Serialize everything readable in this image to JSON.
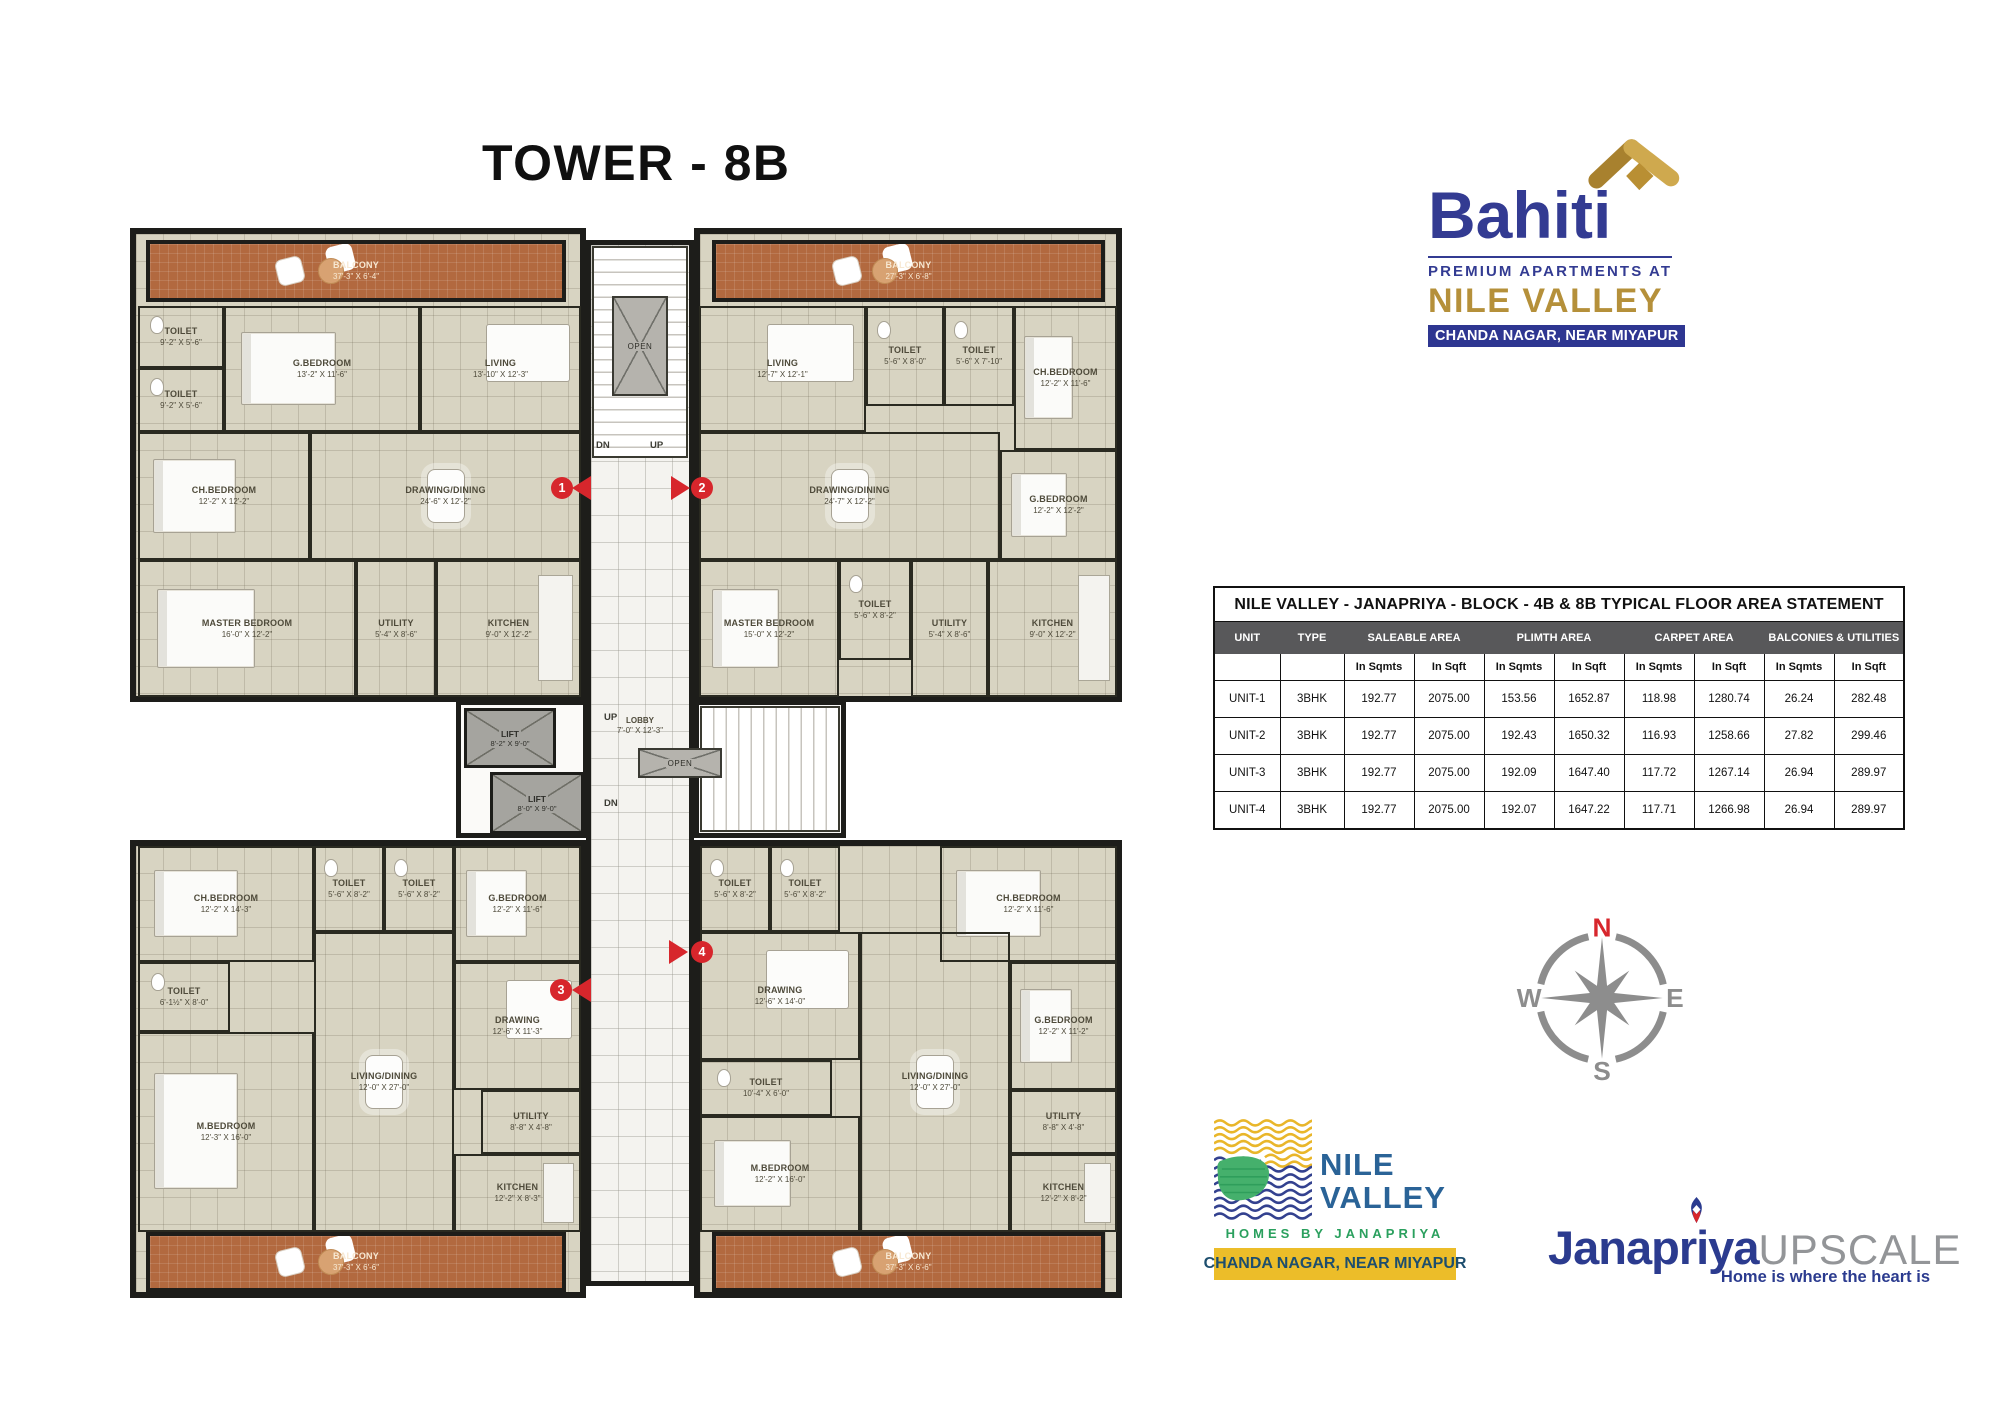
{
  "page": {
    "title": "TOWER - 8B"
  },
  "bahiti": {
    "name": "Bahiti",
    "subtitle": "PREMIUM APARTMENTS AT",
    "project": "NILE VALLEY",
    "location": "CHANDA NAGAR, NEAR MIYAPUR",
    "navy": "#333b92",
    "gold": "#b5903a"
  },
  "table": {
    "title": "NILE VALLEY - JANAPRIYA - BLOCK - 4B & 8B TYPICAL FLOOR AREA STATEMENT",
    "col_unit": "UNIT",
    "col_type": "TYPE",
    "groups": [
      "SALEABLE AREA",
      "PLIMTH AREA",
      "CARPET AREA",
      "BALCONIES & UTILITIES"
    ],
    "sub_sqmts": "In Sqmts",
    "sub_sqft": "In Sqft",
    "rows": [
      {
        "unit": "UNIT-1",
        "type": "3BHK",
        "values": [
          "192.77",
          "2075.00",
          "153.56",
          "1652.87",
          "118.98",
          "1280.74",
          "26.24",
          "282.48"
        ]
      },
      {
        "unit": "UNIT-2",
        "type": "3BHK",
        "values": [
          "192.77",
          "2075.00",
          "192.43",
          "1650.32",
          "116.93",
          "1258.66",
          "27.82",
          "299.46"
        ]
      },
      {
        "unit": "UNIT-3",
        "type": "3BHK",
        "values": [
          "192.77",
          "2075.00",
          "192.09",
          "1647.40",
          "117.72",
          "1267.14",
          "26.94",
          "289.97"
        ]
      },
      {
        "unit": "UNIT-4",
        "type": "3BHK",
        "values": [
          "192.77",
          "2075.00",
          "192.07",
          "1647.22",
          "117.71",
          "1266.98",
          "26.94",
          "289.97"
        ]
      }
    ]
  },
  "compass": {
    "n": "N",
    "e": "E",
    "s": "S",
    "w": "W"
  },
  "nile_valley_logo": {
    "line1": "NILE",
    "line2": "VALLEY",
    "homes": "HOMES BY JANAPRIYA",
    "location": "CHANDA NAGAR, NEAR MIYAPUR"
  },
  "janapriya_logo": {
    "name": "Janapriya",
    "upscale": "UPSCALE",
    "tagline": "Home is where the heart is"
  },
  "plan": {
    "markers": [
      "1",
      "2",
      "3",
      "4"
    ],
    "core": {
      "open": "OPEN",
      "up": "UP",
      "dn": "DN",
      "lobby": "LOBBY",
      "lobby_dims": "7'-0\" X 12'-3\"",
      "lift": "LIFT",
      "lift1_dims": "8'-2\" X 9'-0\"",
      "lift2_dims": "8'-0\" X 9'-0\""
    },
    "units": [
      {
        "name": "UNIT-1",
        "rooms": [
          {
            "name": "BALCONY",
            "dims": "37'-3\" X 6'-4\""
          },
          {
            "name": "TOILET",
            "dims": "9'-2\" X 5'-6\""
          },
          {
            "name": "G.BEDROOM",
            "dims": "13'-2\" X 11'-6\""
          },
          {
            "name": "LIVING",
            "dims": "13'-10\" X 12'-3\""
          },
          {
            "name": "TOILET",
            "dims": "9'-2\" X 5'-6\""
          },
          {
            "name": "DRAWING/DINING",
            "dims": "24'-6\" X 12'-2\""
          },
          {
            "name": "CH.BEDROOM",
            "dims": "12'-2\" X 12'-2\""
          },
          {
            "name": "MASTER BEDROOM",
            "dims": "16'-0\" X 12'-2\""
          },
          {
            "name": "UTILITY",
            "dims": "5'-4\" X 8'-6\""
          },
          {
            "name": "KITCHEN",
            "dims": "9'-0\" X 12'-2\""
          }
        ]
      },
      {
        "name": "UNIT-2",
        "rooms": [
          {
            "name": "BALCONY",
            "dims": "27'-3\" X 6'-8\""
          },
          {
            "name": "LIVING",
            "dims": "12'-7\" X 12'-1\""
          },
          {
            "name": "TOILET",
            "dims": "5'-6\" X 8'-0\""
          },
          {
            "name": "TOILET",
            "dims": "5'-6\" X 7'-10\""
          },
          {
            "name": "CH.BEDROOM",
            "dims": "12'-2\" X 11'-6\""
          },
          {
            "name": "DRAWING/DINING",
            "dims": "24'-7\" X 12'-2\""
          },
          {
            "name": "G.BEDROOM",
            "dims": "12'-2\" X 12'-2\""
          },
          {
            "name": "MASTER BEDROOM",
            "dims": "15'-0\" X 12'-2\""
          },
          {
            "name": "TOILET",
            "dims": "5'-6\" X 8'-2\""
          },
          {
            "name": "UTILITY",
            "dims": "5'-4\" X 8'-6\""
          },
          {
            "name": "KITCHEN",
            "dims": "9'-0\" X 12'-2\""
          }
        ]
      },
      {
        "name": "UNIT-3",
        "rooms": [
          {
            "name": "CH.BEDROOM",
            "dims": "12'-2\" X 14'-3\""
          },
          {
            "name": "TOILET",
            "dims": "5'-6\" X 8'-2\""
          },
          {
            "name": "TOILET",
            "dims": "5'-6\" X 8'-2\""
          },
          {
            "name": "G.BEDROOM",
            "dims": "12'-2\" X 11'-6\""
          },
          {
            "name": "DRAWING",
            "dims": "12'-6\" X 11'-3\""
          },
          {
            "name": "TOILET",
            "dims": "6'-1½\" X 8'-0\""
          },
          {
            "name": "M.BEDROOM",
            "dims": "12'-3\" X 16'-0\""
          },
          {
            "name": "LIVING/DINING",
            "dims": "12'-0\" X 27'-0\""
          },
          {
            "name": "UTILITY",
            "dims": "8'-8\" X 4'-8\""
          },
          {
            "name": "KITCHEN",
            "dims": "12'-2\" X 8'-3\""
          },
          {
            "name": "BALCONY",
            "dims": "37'-3\" X 6'-6\""
          }
        ]
      },
      {
        "name": "UNIT-4",
        "rooms": [
          {
            "name": "TOILET",
            "dims": "5'-6\" X 8'-2\""
          },
          {
            "name": "TOILET",
            "dims": "5'-6\" X 8'-2\""
          },
          {
            "name": "CH.BEDROOM",
            "dims": "12'-2\" X 11'-6\""
          },
          {
            "name": "DRAWING",
            "dims": "12'-6\" X 14'-0\""
          },
          {
            "name": "TOILET",
            "dims": "10'-4\" X 6'-0\""
          },
          {
            "name": "M.BEDROOM",
            "dims": "12'-2\" X 16'-0\""
          },
          {
            "name": "LIVING/DINING",
            "dims": "12'-0\" X 27'-0\""
          },
          {
            "name": "G.BEDROOM",
            "dims": "12'-2\" X 11'-2\""
          },
          {
            "name": "UTILITY",
            "dims": "8'-8\" X 4'-8\""
          },
          {
            "name": "KITCHEN",
            "dims": "12'-2\" X 8'-2\""
          },
          {
            "name": "BALCONY",
            "dims": "37'-3\" X 6'-6\""
          }
        ]
      }
    ]
  }
}
